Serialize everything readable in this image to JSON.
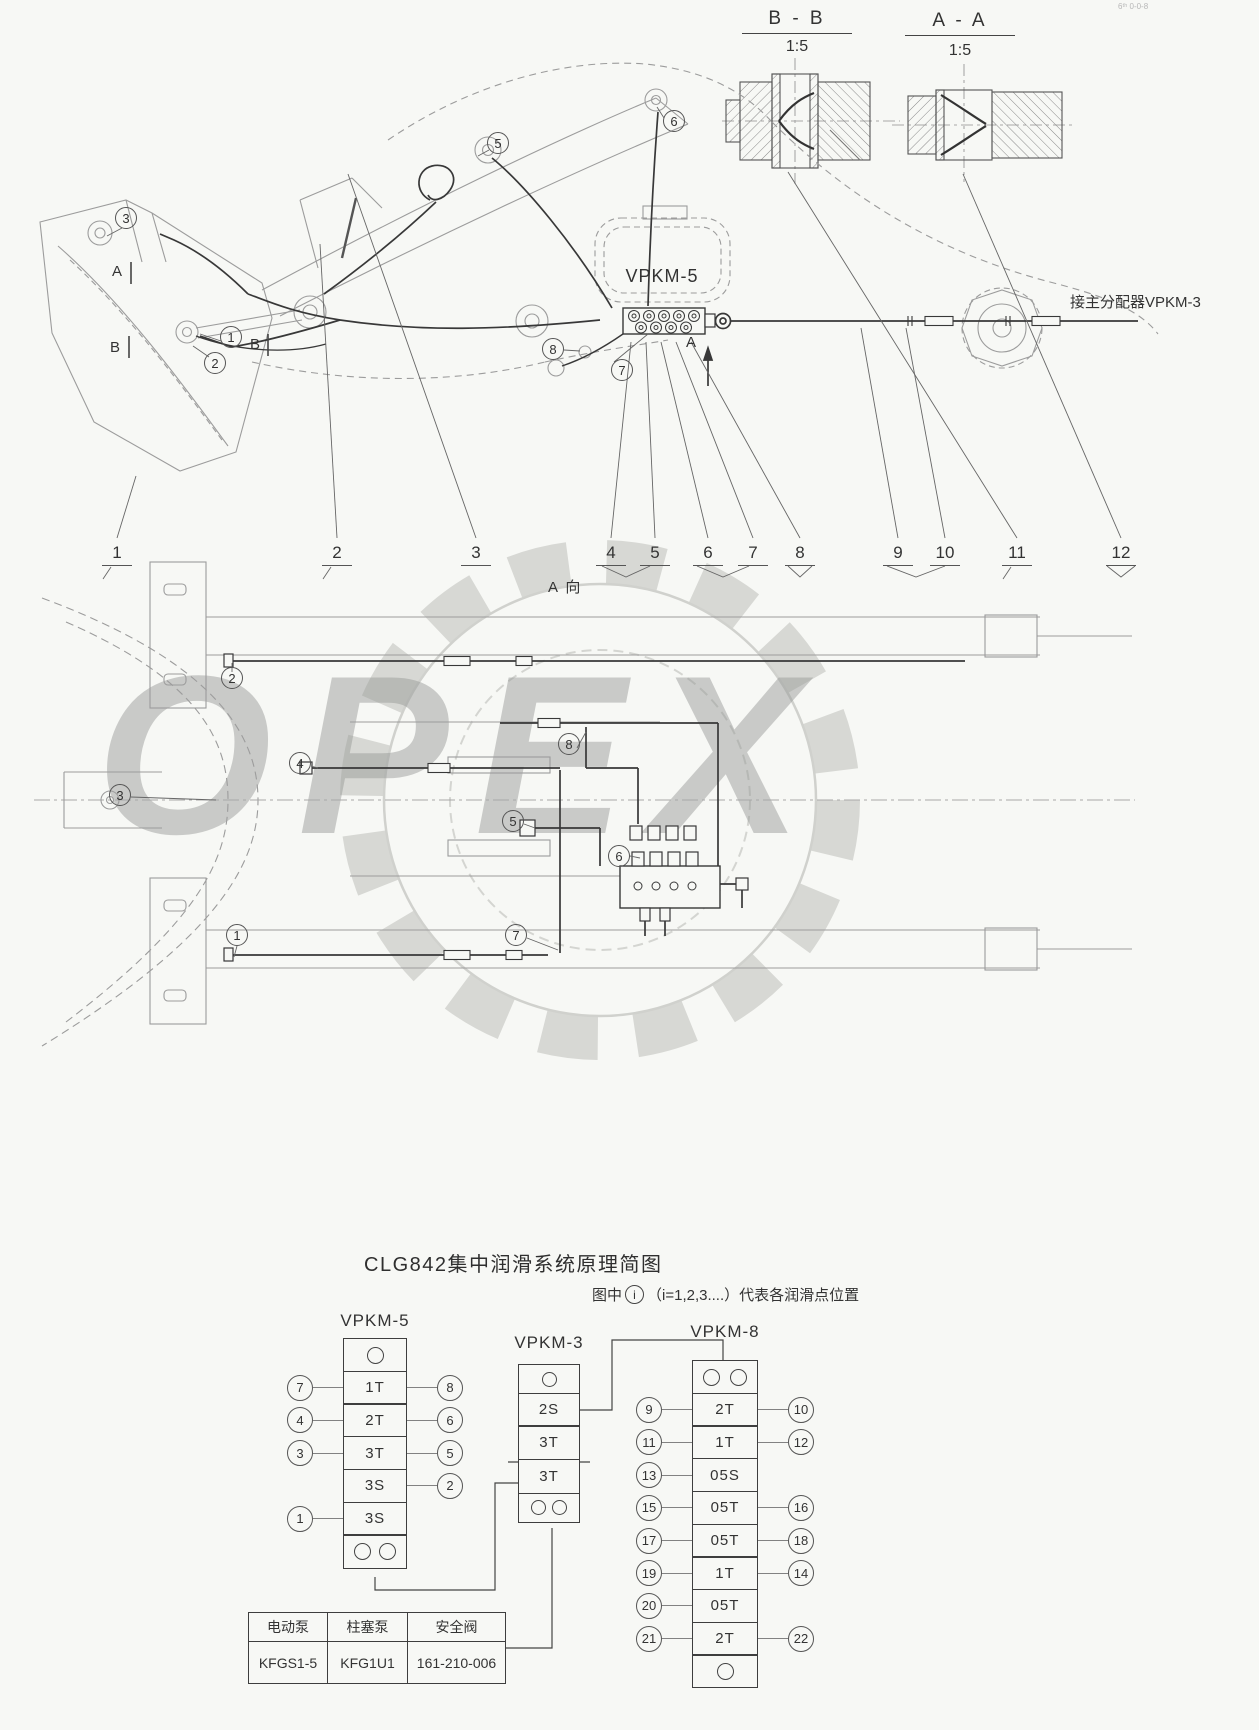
{
  "corner_mark": "6ᵗʰ 0-0-8",
  "watermark": {
    "text": "OPEX"
  },
  "side_view": {
    "sections": {
      "bb_label": "B - B",
      "bb_scale": "1:5",
      "aa_label": "A - A",
      "aa_scale": "1:5"
    },
    "distributor_label": "VPKM-5",
    "pipe_note": "接主分配器VPKM-3",
    "view_arrow_label": "A",
    "section_marks": [
      "A",
      "B",
      "B"
    ],
    "callouts": {
      "c1": "1",
      "c2": "2",
      "c3": "3",
      "c5": "5",
      "c6": "6",
      "c7": "7",
      "c8": "8"
    },
    "item_numbers": [
      "1",
      "2",
      "3",
      "4",
      "5",
      "6",
      "7",
      "8",
      "9",
      "10",
      "11",
      "12"
    ]
  },
  "plan_view": {
    "view_label": "A 向",
    "callouts": {
      "p1": "1",
      "p2": "2",
      "p3": "3",
      "p4": "4",
      "p5": "5",
      "p6": "6",
      "p7": "7",
      "p8": "8"
    }
  },
  "schematic": {
    "title": "CLG842集中润滑系统原理简图",
    "note": {
      "prefix": "图中",
      "circle": "i",
      "suffix": "（i=1,2,3....）代表各润滑点位置"
    },
    "blocks": {
      "vpkm5": {
        "title": "VPKM-5",
        "rows": [
          {
            "label": "1T",
            "left": "7",
            "right": "8"
          },
          {
            "label": "2T",
            "left": "4",
            "right": "6"
          },
          {
            "label": "3T",
            "left": "3",
            "right": "5"
          },
          {
            "label": "3S",
            "left": "",
            "right": "2"
          },
          {
            "label": "3S",
            "left": "1",
            "right": ""
          }
        ]
      },
      "vpkm3": {
        "title": "VPKM-3",
        "rows": [
          {
            "label": "2S"
          },
          {
            "label": "3T"
          },
          {
            "label": "3T"
          }
        ]
      },
      "vpkm8": {
        "title": "VPKM-8",
        "rows": [
          {
            "label": "2T",
            "left": "9",
            "right": "10"
          },
          {
            "label": "1T",
            "left": "11",
            "right": "12"
          },
          {
            "label": "05S",
            "left": "13",
            "right": ""
          },
          {
            "label": "05T",
            "left": "15",
            "right": "16"
          },
          {
            "label": "05T",
            "left": "17",
            "right": "18"
          },
          {
            "label": "1T",
            "left": "19",
            "right": "14"
          },
          {
            "label": "05T",
            "left": "20",
            "right": ""
          },
          {
            "label": "2T",
            "left": "21",
            "right": "22"
          }
        ]
      }
    },
    "pump_table": {
      "columns": [
        {
          "name": "电动泵",
          "model": "KFGS1-5"
        },
        {
          "name": "柱塞泵",
          "model": "KFG1U1"
        },
        {
          "name": "安全阀",
          "model": "161-210-006"
        }
      ]
    }
  }
}
